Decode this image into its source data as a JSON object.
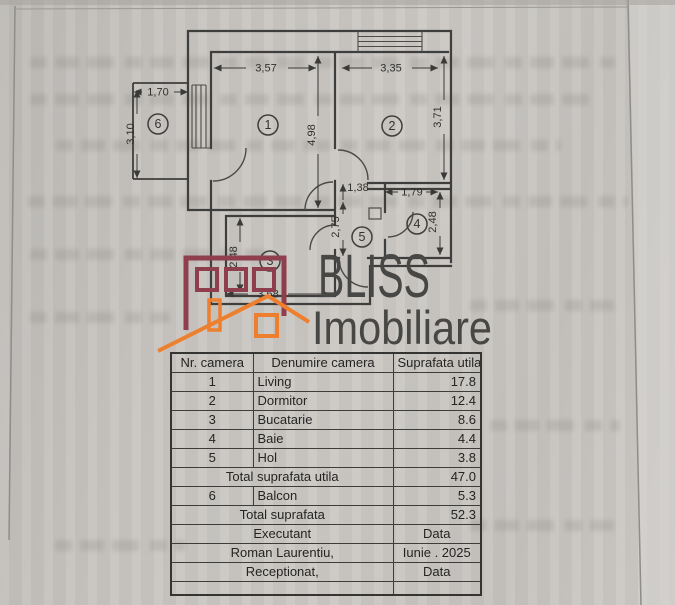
{
  "floor_plan": {
    "room_labels": [
      "1",
      "2",
      "3",
      "4",
      "5",
      "6"
    ],
    "dimensions": {
      "living_width": "3,57",
      "dormitor_width": "3,35",
      "living_height": "4,98",
      "dormitor_height": "3,71",
      "balcon_width": "1,70",
      "balcon_height": "3,10",
      "hol_opening": "1,38",
      "baie_width": "1,79",
      "hol_height": "2,75",
      "baie_height": "2,48",
      "bucatarie_height": "2,48",
      "bucatarie_width": "3,68"
    }
  },
  "logo": {
    "line1": "BLISS",
    "line2": "Imobiliare",
    "building_color": "#8e3e4d",
    "house_color": "#ee7f2f",
    "text_color": "#474745"
  },
  "table": {
    "headers": {
      "col1": "Nr. camera",
      "col2": "Denumire camera",
      "col3": "Suprafata utila (mp)"
    },
    "rows": [
      {
        "nr": "1",
        "name": "Living",
        "area": "17.8"
      },
      {
        "nr": "2",
        "name": "Dormitor",
        "area": "12.4"
      },
      {
        "nr": "3",
        "name": "Bucatarie",
        "area": "8.6"
      },
      {
        "nr": "4",
        "name": "Baie",
        "area": "4.4"
      },
      {
        "nr": "5",
        "name": "Hol",
        "area": "3.8"
      }
    ],
    "total_utila": {
      "label": "Total suprafata utila",
      "value": "47.0"
    },
    "balcon": {
      "nr": "6",
      "name": "Balcon",
      "area": "5.3"
    },
    "total": {
      "label": "Total suprafata",
      "value": "52.3"
    },
    "executant": {
      "label": "Executant",
      "value": "Data"
    },
    "author": {
      "label": "Roman Laurentiu,",
      "value": "Iunie . 2025"
    },
    "receptionat": {
      "label": "Receptionat,",
      "value": "Data"
    }
  }
}
